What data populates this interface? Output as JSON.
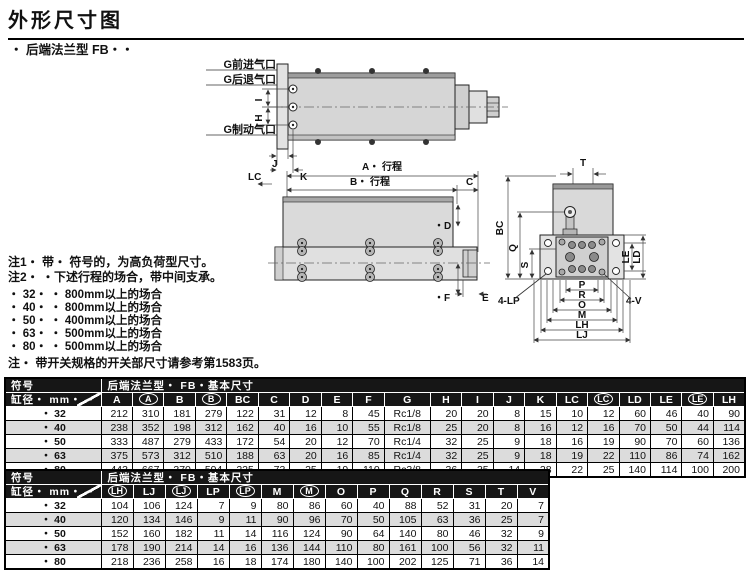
{
  "page": {
    "title": "外形尺寸图",
    "subtitle": "・ 后端法兰型  FB・・"
  },
  "drawing": {
    "labels": {
      "port_advance": "G前进气口",
      "port_retract": "G后退气口",
      "port_brake": "G制动气口",
      "dim_i": "I",
      "dim_h": "H",
      "dim_j": "J",
      "dim_k": "K",
      "dim_lc": "LC",
      "dim_a_stroke": "A・ 行程",
      "dim_b_stroke": "B・ 行程",
      "dim_c": "C",
      "dim_d": "・D",
      "dim_f": "・F",
      "dim_e": "E",
      "dim_t": "T",
      "dim_bc": "BC",
      "dim_q": "Q",
      "dim_s": "S",
      "dim_le": "LE",
      "dim_ld": "LD",
      "holes_lp": "4-LP",
      "holes_v": "4-V",
      "dim_p": "P",
      "dim_r": "R",
      "dim_o": "O",
      "dim_m": "M",
      "dim_lh": "LH",
      "dim_lj": "LJ"
    }
  },
  "notes": {
    "note1": "注1・ 带・ 符号的，为高负荷型尺寸。",
    "note2": "注2・ ・下述行程的场合，带中间支承。",
    "stroke_cases": [
      "・ 32・ ・ 800mm以上的场合",
      "・ 40・ ・ 800mm以上的场合",
      "・ 50・ ・ 400mm以上的场合",
      "・ 63・ ・ 500mm以上的场合",
      "・ 80・ ・ 500mm以上的场合"
    ],
    "note_switch": "注・ 带开关规格的开关部尺寸请参考第1583页。"
  },
  "tables": [
    {
      "corner_label": "符号",
      "title": "后端法兰型・ FB・基本尺寸",
      "row_header": "缸径・ mm・ ・",
      "columns": [
        {
          "t": "A"
        },
        {
          "t": "A",
          "circled": true
        },
        {
          "t": "B"
        },
        {
          "t": "B",
          "circled": true
        },
        {
          "t": "BC"
        },
        {
          "t": "C"
        },
        {
          "t": "D"
        },
        {
          "t": "E"
        },
        {
          "t": "F"
        },
        {
          "t": "G"
        },
        {
          "t": "H"
        },
        {
          "t": "I"
        },
        {
          "t": "J"
        },
        {
          "t": "K"
        },
        {
          "t": "LC"
        },
        {
          "t": "LC",
          "circled": true
        },
        {
          "t": "LD"
        },
        {
          "t": "LE"
        },
        {
          "t": "LE",
          "circled": true
        },
        {
          "t": "LH"
        }
      ],
      "rows": [
        {
          "bore": "・ 32",
          "values": [
            212,
            310,
            181,
            279,
            122,
            31,
            12,
            8,
            45,
            "Rc1/8",
            20,
            20,
            8,
            15,
            10,
            12,
            60,
            46,
            40,
            90
          ]
        },
        {
          "bore": "・ 40",
          "values": [
            238,
            352,
            198,
            312,
            162,
            40,
            16,
            10,
            55,
            "Rc1/8",
            25,
            20,
            8,
            16,
            12,
            16,
            70,
            50,
            44,
            114
          ]
        },
        {
          "bore": "・ 50",
          "values": [
            333,
            487,
            279,
            433,
            172,
            54,
            20,
            12,
            70,
            "Rc1/4",
            32,
            25,
            9,
            18,
            16,
            19,
            90,
            70,
            60,
            136
          ]
        },
        {
          "bore": "・ 63",
          "values": [
            375,
            573,
            312,
            510,
            188,
            63,
            20,
            16,
            85,
            "Rc1/4",
            32,
            25,
            9,
            18,
            19,
            22,
            110,
            86,
            74,
            162
          ]
        },
        {
          "bore": "・ 80",
          "values": [
            443,
            667,
            370,
            594,
            225,
            73,
            25,
            19,
            110,
            "Rc3/8",
            36,
            35,
            14,
            28,
            22,
            25,
            140,
            114,
            100,
            200
          ]
        }
      ]
    },
    {
      "corner_label": "符号",
      "title": "后端法兰型・ FB・基本尺寸",
      "row_header": "缸径・ mm・ ・",
      "columns": [
        {
          "t": "LH",
          "circled": true
        },
        {
          "t": "LJ"
        },
        {
          "t": "LJ",
          "circled": true
        },
        {
          "t": "LP"
        },
        {
          "t": "LP",
          "circled": true
        },
        {
          "t": "M"
        },
        {
          "t": "M",
          "circled": true
        },
        {
          "t": "O"
        },
        {
          "t": "P"
        },
        {
          "t": "Q"
        },
        {
          "t": "R"
        },
        {
          "t": "S"
        },
        {
          "t": "T"
        },
        {
          "t": "V"
        }
      ],
      "rows": [
        {
          "bore": "・ 32",
          "values": [
            104,
            106,
            124,
            7,
            9,
            80,
            86,
            60,
            40,
            88,
            52,
            31,
            20,
            7
          ]
        },
        {
          "bore": "・ 40",
          "values": [
            120,
            134,
            146,
            9,
            11,
            90,
            96,
            70,
            50,
            105,
            63,
            36,
            25,
            7
          ]
        },
        {
          "bore": "・ 50",
          "values": [
            152,
            160,
            182,
            11,
            14,
            116,
            124,
            90,
            64,
            140,
            80,
            46,
            32,
            9
          ]
        },
        {
          "bore": "・ 63",
          "values": [
            178,
            190,
            214,
            14,
            16,
            136,
            144,
            110,
            80,
            161,
            100,
            56,
            32,
            11
          ]
        },
        {
          "bore": "・ 80",
          "values": [
            218,
            236,
            258,
            16,
            18,
            174,
            180,
            140,
            100,
            202,
            125,
            71,
            36,
            14
          ]
        }
      ]
    }
  ]
}
